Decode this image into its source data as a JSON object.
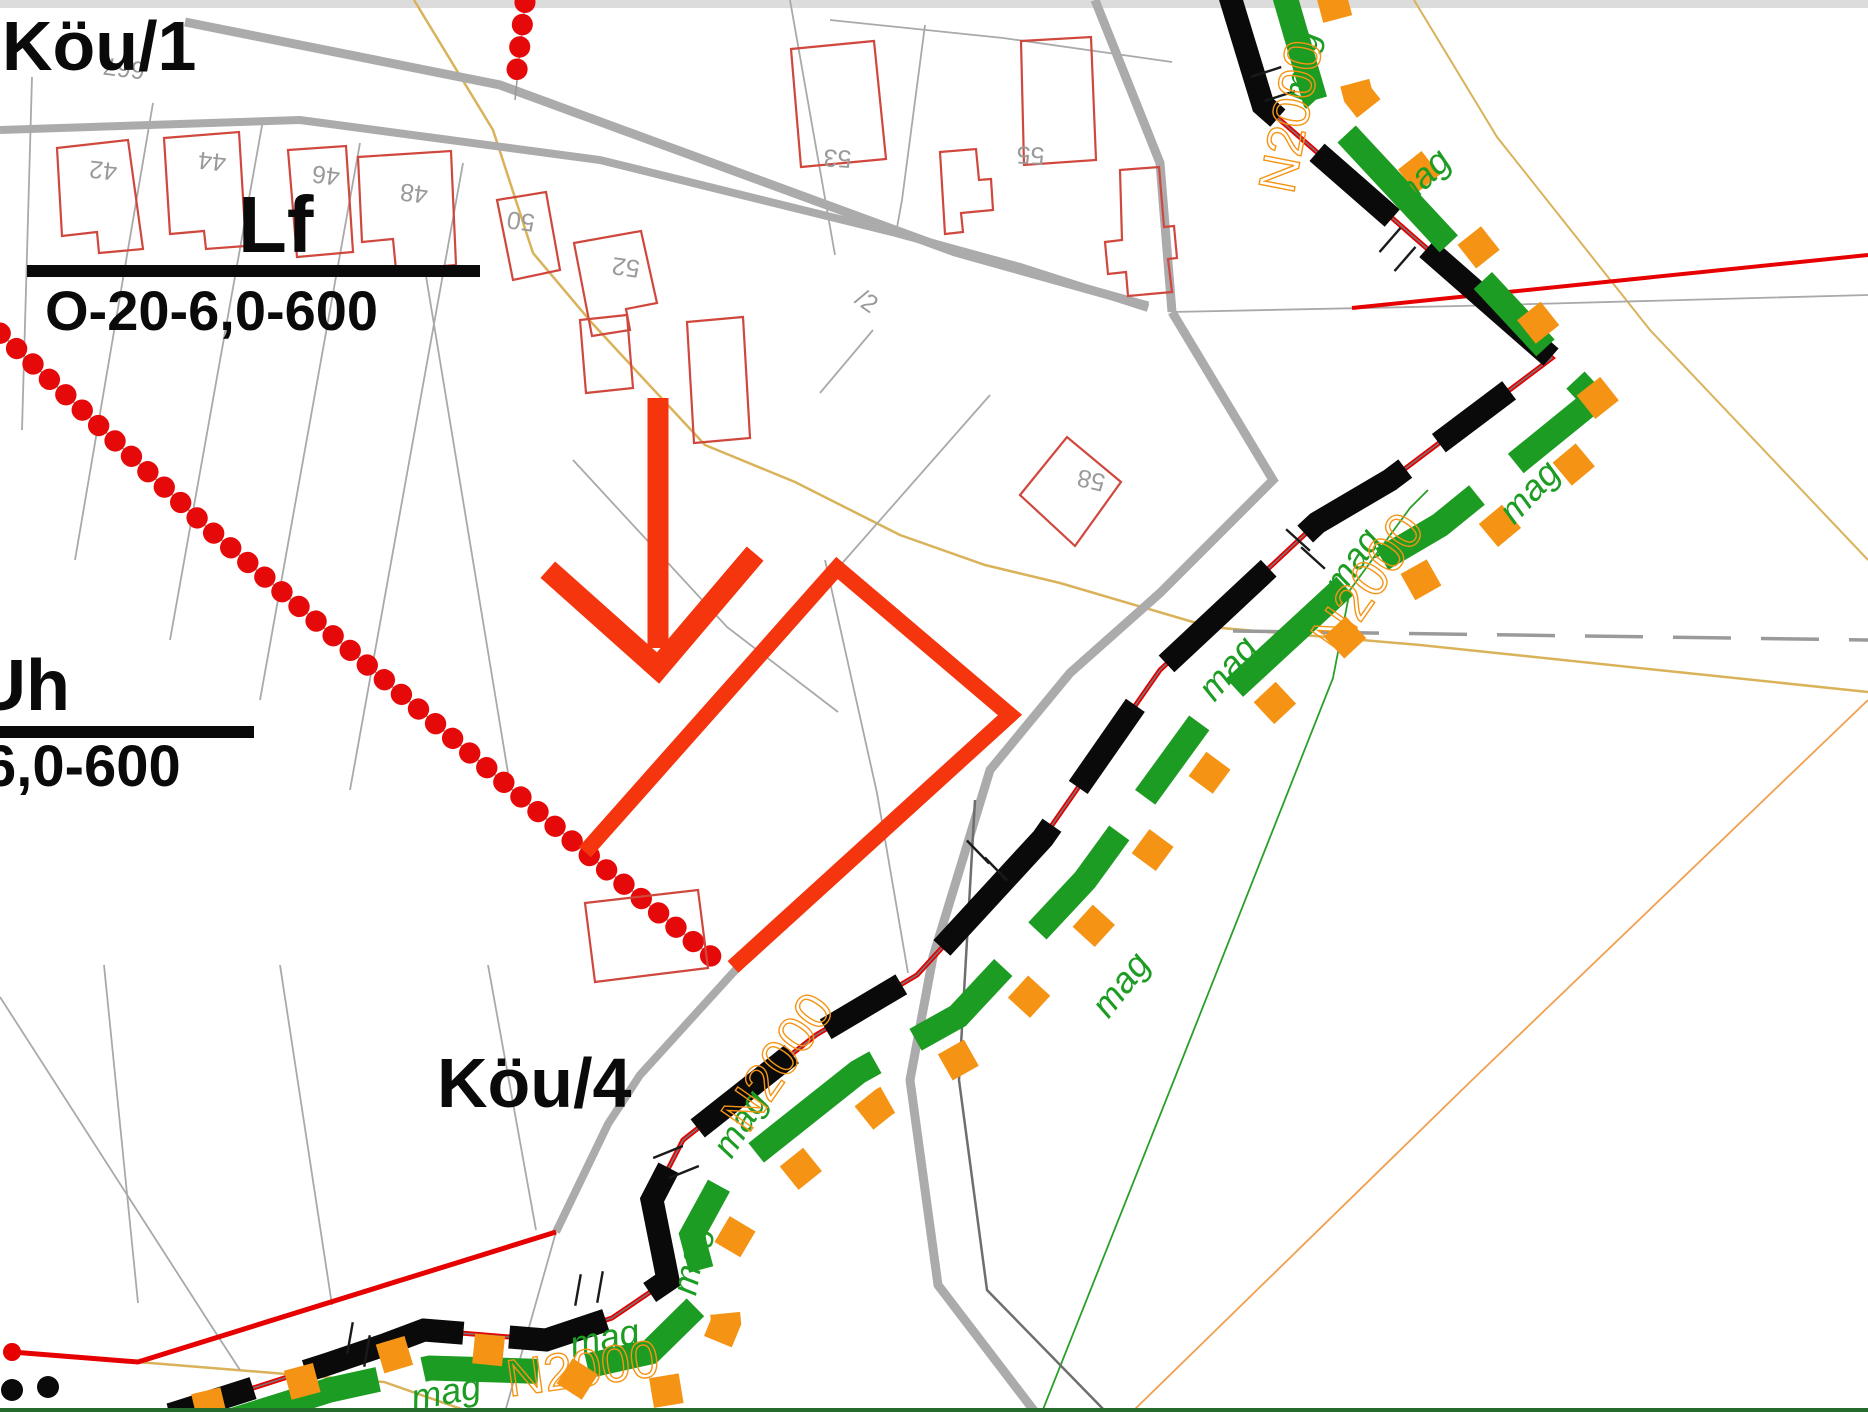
{
  "zones": {
    "kou1": "Köu/1",
    "kou4": "Köu/4",
    "lf": {
      "code": "Lf",
      "spec": "O-20-6,0-600"
    },
    "uh": {
      "code": "Uh",
      "spec": "6,0-600"
    }
  },
  "parcel_numbers": {
    "n42": "42",
    "n44": "44",
    "n46": "46",
    "n48": "48",
    "n50": "50",
    "n52": "52",
    "n53": "53",
    "n55": "55",
    "n58": "58",
    "n667": "667",
    "slash2": "/2"
  },
  "utility_labels": {
    "mag": "mag",
    "n2000": "N2000"
  },
  "colors": {
    "highlight_red": "#f5350e",
    "boundary_red": "#e60000",
    "building_red": "#d0473d",
    "road_gray": "#ababab",
    "parcel_gray": "#a9a9a9",
    "dash_black": "#0a0a0a",
    "utility_green": "#1c9c22",
    "utility_orange": "#f59414",
    "terrain_tan": "#d9b25a",
    "label_gray": "#9a9a9a"
  }
}
